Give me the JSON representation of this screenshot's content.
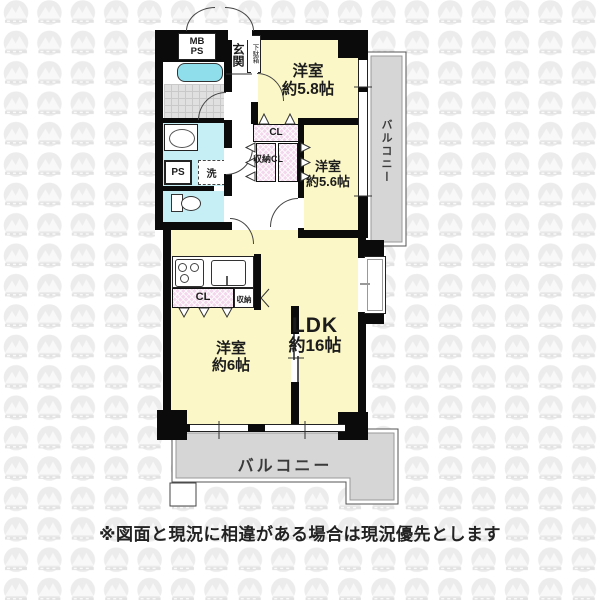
{
  "plan": {
    "meter_box": {
      "line1": "MB",
      "line2": "PS"
    },
    "entrance": {
      "label": "玄関",
      "shoe_cabinet": "下駄箱"
    },
    "washroom": {
      "pipe_space": "PS",
      "washer": "洗"
    },
    "rooms": {
      "bedroom_a": {
        "name": "洋室",
        "size": "約5.8帖"
      },
      "bedroom_b": {
        "name": "洋室",
        "size": "約5.6帖"
      },
      "bedroom_c": {
        "name": "洋室",
        "size": "約6帖"
      },
      "ldk": {
        "name": "LDK",
        "size": "約16帖"
      }
    },
    "closets": {
      "cl_upper": "CL",
      "storage_cl": "収納CL",
      "cl_lower": "CL",
      "storage_lower": "収納"
    },
    "balcony_right": "バルコニー",
    "balcony_bottom": "バルコニー"
  },
  "footer": {
    "disclaimer": "※図面と現況に相違がある場合は現況優先とします"
  },
  "colors": {
    "room-yellow": "#FBF7C6",
    "water-cyan": "#C6EEF5",
    "tub-cyan": "#8FDEEC",
    "closet-pink": "#F3D7EC",
    "balcony-gray": "#D6D6D6",
    "wall-black": "#0B0B0B",
    "label-ink": "#1C1C1C",
    "watermark-gray": "#ECECEC"
  }
}
